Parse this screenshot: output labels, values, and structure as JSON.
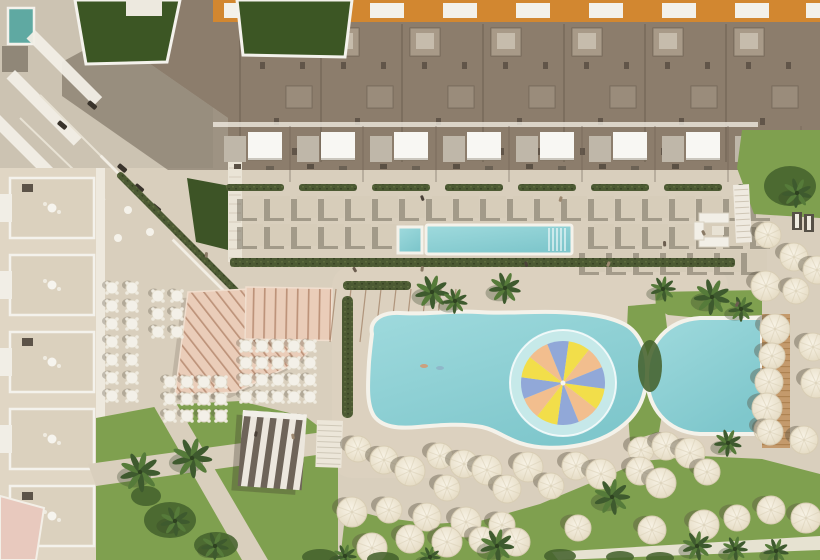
{
  "meta": {
    "title": "Aerial rendering of resort with pools, sun umbrellas and gardens",
    "canvas": {
      "w": 820,
      "h": 560
    }
  },
  "palette": {
    "sand": "#D9CFBD",
    "sandLight": "#E2D9C7",
    "plazaGray": "#CCC3B2",
    "deckLight": "#DED4C1",
    "roof": "#8C7D6C",
    "roofShade": "#7E7060",
    "roofUnit": "#A89A88",
    "roofUnitIn": "#C6BCAC",
    "roofUnit2": "#9A8C7B",
    "orange": "#D28730",
    "windowWhite": "#F3F1EA",
    "white": "#F4F2EC",
    "brightWhite": "#F8F7F3",
    "grayCabana": "#BFB7A9",
    "pad": "#D7CDBA",
    "padShadow": "rgba(95,88,74,0.45)",
    "water": "#7FC7CC",
    "waterLight": "#9FDADD",
    "rim": "#F4F2EA",
    "splashRing": "#C9EAEA",
    "lawn": "#7FA04F",
    "lawnDark": "#46622E",
    "lawnShadow": "#5E8140",
    "greenRoof": "#3C5624",
    "hedge": "#4C5A33",
    "hedgeLight": "#7C8F58",
    "pink": "#EACDB9",
    "pinkLine": "#BD937A",
    "stripeDark": "#6E6459",
    "stripeLight": "#ECE7DE",
    "wood": "#C49A6C",
    "woodLine": "#AE8352",
    "umbrella": "#F2EBDA",
    "umbrellaEdge": "#D8CDB4",
    "tealRoof": "#5FA9A2",
    "pinkRoof": "#E8C9BE",
    "shadow": "rgba(90,82,66,0.40)",
    "darkDot": "#4A4038"
  },
  "pinwheel": {
    "cx": 563,
    "cy": 383,
    "r": 42,
    "ringR": 53,
    "segments": 12,
    "startDeg": 8,
    "colors": [
      "#F2DE4A",
      "#F2BE8E",
      "#91A8D8"
    ]
  },
  "pools": {
    "main": "M372,334 C369,320 382,312 400,313 C428,315 452,310 478,312 C505,314 530,311 556,312 C582,313 606,315 624,324 C638,331 646,348 647,366 C648,388 642,407 629,420 C617,432 600,441 580,445 C560,449 538,449 520,443 C505,438 496,430 482,427 C462,423 440,425 418,427 C398,429 382,427 374,416 C366,404 368,382 369,362 C370,350 371,342 372,334 Z",
    "right": "M700,318 L762,318 L762,434 L700,434 C666,432 647,407 647,376 C647,343 668,320 700,318 Z",
    "lap": {
      "x": 426,
      "y": 225,
      "w": 146,
      "h": 29
    },
    "lapSmall": {
      "x": 398,
      "y": 227,
      "w": 24,
      "h": 26
    },
    "laneLinesX": [
      549,
      553,
      557,
      561,
      565
    ],
    "swimmers": [
      [
        424,
        366
      ],
      [
        440,
        368
      ]
    ]
  },
  "woodDeck": {
    "x": 762,
    "y": 314,
    "w": 28,
    "h": 134
  },
  "lawns": {
    "left": "96,418 165,405 240,401 306,417 338,441 338,560 96,560",
    "bottom": "340,560 346,508 380,517 432,524 480,521 540,504 600,479 642,461 700,456 762,459 820,474 820,560",
    "between": "628,306 664,303 671,360 659,432 630,441 625,374",
    "aboveRight": "655,292 762,290 762,315 700,318 668,315 656,308",
    "topRight": "742,130 820,130 820,218 754,214 737,168",
    "pathA": "88,464 338,430 338,452 96,486",
    "pathB": "152,403 176,403 268,560 242,560",
    "bottomPath": "552,552 820,536 820,550 558,560"
  },
  "canopy": {
    "diagPoly": "188,292 250,289 318,338 302,360 236,392 175,395",
    "vertRect": {
      "x": 246,
      "y": 287,
      "w": 86,
      "h": 52
    },
    "raysX": [
      336,
      351,
      366,
      381,
      396,
      411,
      426,
      441,
      456
    ]
  },
  "pavilion": {
    "x": 243,
    "y": 410,
    "w": 64,
    "h": 76,
    "rot": 4
  },
  "stairsCenter": {
    "x": 317,
    "y": 420,
    "w": 26,
    "h": 47
  },
  "stairsRight": {
    "x": 733,
    "y": 185,
    "w": 16,
    "h": 58
  },
  "hedges": {
    "poolRow": {
      "x": 230,
      "y": 258,
      "w": 505,
      "h": 9
    },
    "leftOfPool": {
      "x": 342,
      "y": 296,
      "w": 11,
      "h": 122
    },
    "topOfPool": {
      "x": 343,
      "y": 281,
      "w": 68,
      "h": 9
    },
    "diag": [
      [
        150,
        205
      ],
      [
        178,
        233
      ],
      [
        206,
        261
      ]
    ]
  },
  "terraceLines": [
    [
      136,
      191
    ],
    [
      164,
      219
    ],
    [
      192,
      247
    ],
    [
      208,
      275
    ]
  ],
  "greenWedge": "187,178 230,186 228,250 196,242",
  "whiteStrip": {
    "x": 228,
    "y": 162,
    "w": 14,
    "h": 100
  },
  "topBlock": {
    "poly": "110,0 820,0 820,170 228,170 228,118 110,36",
    "shadowPoly": "110,36 228,118 228,170 168,170 62,96 62,62",
    "unitX": [
      248,
      329,
      410,
      491,
      572,
      653,
      734
    ],
    "windowX": [
      224,
      297,
      370,
      443,
      516,
      589,
      662,
      735,
      806
    ],
    "greenRoofA": "75,0 180,0 167,62 86,64",
    "greenRoofB": "237,0 352,0 345,57 243,55",
    "tealPool": {
      "x": 8,
      "y": 8,
      "w": 26,
      "h": 36
    },
    "graySquare": {
      "x": 2,
      "y": 46,
      "w": 26,
      "h": 26
    },
    "whiteRoofTL": {
      "x": 126,
      "y": 0,
      "w": 36,
      "h": 16
    }
  },
  "canopyRow": {
    "unitX": [
      222,
      295,
      368,
      441,
      514,
      587,
      660,
      733
    ]
  },
  "padRows": [
    {
      "y": 196,
      "x0": 243,
      "x1": 770,
      "step": 27
    },
    {
      "y": 224,
      "x0": 243,
      "x1": 770,
      "step": 27,
      "skipFrom": 412,
      "skipTo": 588
    },
    {
      "y": 250,
      "x0": 585,
      "x1": 770,
      "step": 27
    }
  ],
  "leftWing": {
    "x": 0,
    "y": 168,
    "w": 104,
    "h": 392,
    "unitYs": [
      178,
      255,
      332,
      409,
      486
    ],
    "pinkRoof": "0,496 44,508 36,560 0,560"
  },
  "tables": [
    {
      "x": 112,
      "y": 288,
      "cols": 2,
      "rows": 7,
      "dx": 20,
      "dy": 18
    },
    {
      "x": 158,
      "y": 296,
      "cols": 2,
      "rows": 3,
      "dx": 19,
      "dy": 18
    },
    {
      "x": 170,
      "y": 382,
      "cols": 4,
      "rows": 3,
      "dx": 17,
      "dy": 17
    },
    {
      "x": 246,
      "y": 346,
      "cols": 5,
      "rows": 4,
      "dx": 16,
      "dy": 17
    }
  ],
  "umbrellas": [
    [
      358,
      449
    ],
    [
      384,
      460
    ],
    [
      410,
      471
    ],
    [
      440,
      456
    ],
    [
      464,
      464
    ],
    [
      487,
      470
    ],
    [
      447,
      488
    ],
    [
      507,
      489
    ],
    [
      528,
      467
    ],
    [
      551,
      486
    ],
    [
      576,
      466
    ],
    [
      601,
      474
    ],
    [
      641,
      450
    ],
    [
      666,
      446
    ],
    [
      690,
      453
    ],
    [
      707,
      472
    ],
    [
      640,
      471
    ],
    [
      661,
      483
    ],
    [
      767,
      430
    ],
    [
      804,
      440
    ],
    [
      352,
      512
    ],
    [
      389,
      510
    ],
    [
      427,
      517
    ],
    [
      466,
      522
    ],
    [
      502,
      525
    ],
    [
      410,
      539
    ],
    [
      447,
      542
    ],
    [
      482,
      540
    ],
    [
      516,
      542
    ],
    [
      372,
      548
    ],
    [
      578,
      528
    ],
    [
      652,
      530
    ],
    [
      704,
      525
    ],
    [
      737,
      518
    ],
    [
      771,
      510
    ],
    [
      806,
      518
    ],
    [
      768,
      235
    ],
    [
      794,
      257
    ],
    [
      766,
      286
    ],
    [
      796,
      291
    ],
    [
      817,
      270
    ],
    [
      775,
      329
    ],
    [
      772,
      356
    ],
    [
      769,
      382
    ],
    [
      767,
      408
    ],
    [
      770,
      432
    ],
    [
      813,
      347
    ],
    [
      816,
      383
    ]
  ],
  "palms": [
    [
      432,
      292,
      16
    ],
    [
      455,
      301,
      12
    ],
    [
      505,
      288,
      15
    ],
    [
      663,
      289,
      12
    ],
    [
      712,
      297,
      17
    ],
    [
      741,
      309,
      12
    ],
    [
      728,
      443,
      13
    ],
    [
      797,
      193,
      14
    ],
    [
      140,
      472,
      19
    ],
    [
      192,
      458,
      19
    ],
    [
      175,
      521,
      14
    ],
    [
      215,
      546,
      13
    ],
    [
      345,
      556,
      11
    ],
    [
      430,
      557,
      10
    ],
    [
      497,
      546,
      16
    ],
    [
      612,
      497,
      17
    ],
    [
      697,
      546,
      14
    ],
    [
      735,
      549,
      12
    ],
    [
      776,
      551,
      12
    ]
  ],
  "bushes": [
    [
      170,
      520,
      26,
      18
    ],
    [
      216,
      545,
      22,
      13
    ],
    [
      146,
      496,
      15,
      10
    ],
    [
      320,
      557,
      18,
      8
    ],
    [
      383,
      559,
      16,
      7
    ],
    [
      560,
      556,
      16,
      7
    ],
    [
      620,
      557,
      14,
      6
    ],
    [
      660,
      558,
      14,
      6
    ],
    [
      790,
      186,
      26,
      20
    ],
    [
      650,
      366,
      12,
      26
    ]
  ],
  "loungeSet": {
    "x": 694,
    "y": 210
  },
  "darkLoungers": [
    [
      792,
      212
    ],
    [
      804,
      214
    ]
  ],
  "cars": [
    [
      120,
      163
    ],
    [
      137,
      183
    ],
    [
      154,
      203
    ],
    [
      171,
      223
    ],
    [
      60,
      120
    ],
    [
      90,
      100
    ]
  ],
  "people": [
    [
      352,
      268
    ],
    [
      421,
      266
    ],
    [
      524,
      262
    ],
    [
      608,
      261
    ],
    [
      663,
      241
    ],
    [
      701,
      231
    ],
    [
      255,
      431
    ],
    [
      291,
      434
    ],
    [
      737,
      301
    ],
    [
      205,
      252
    ],
    [
      420,
      196
    ],
    [
      560,
      196
    ]
  ],
  "peopleColors": [
    "#6B5D4F",
    "#8A7A66",
    "#4A4038",
    "#9C8870"
  ]
}
